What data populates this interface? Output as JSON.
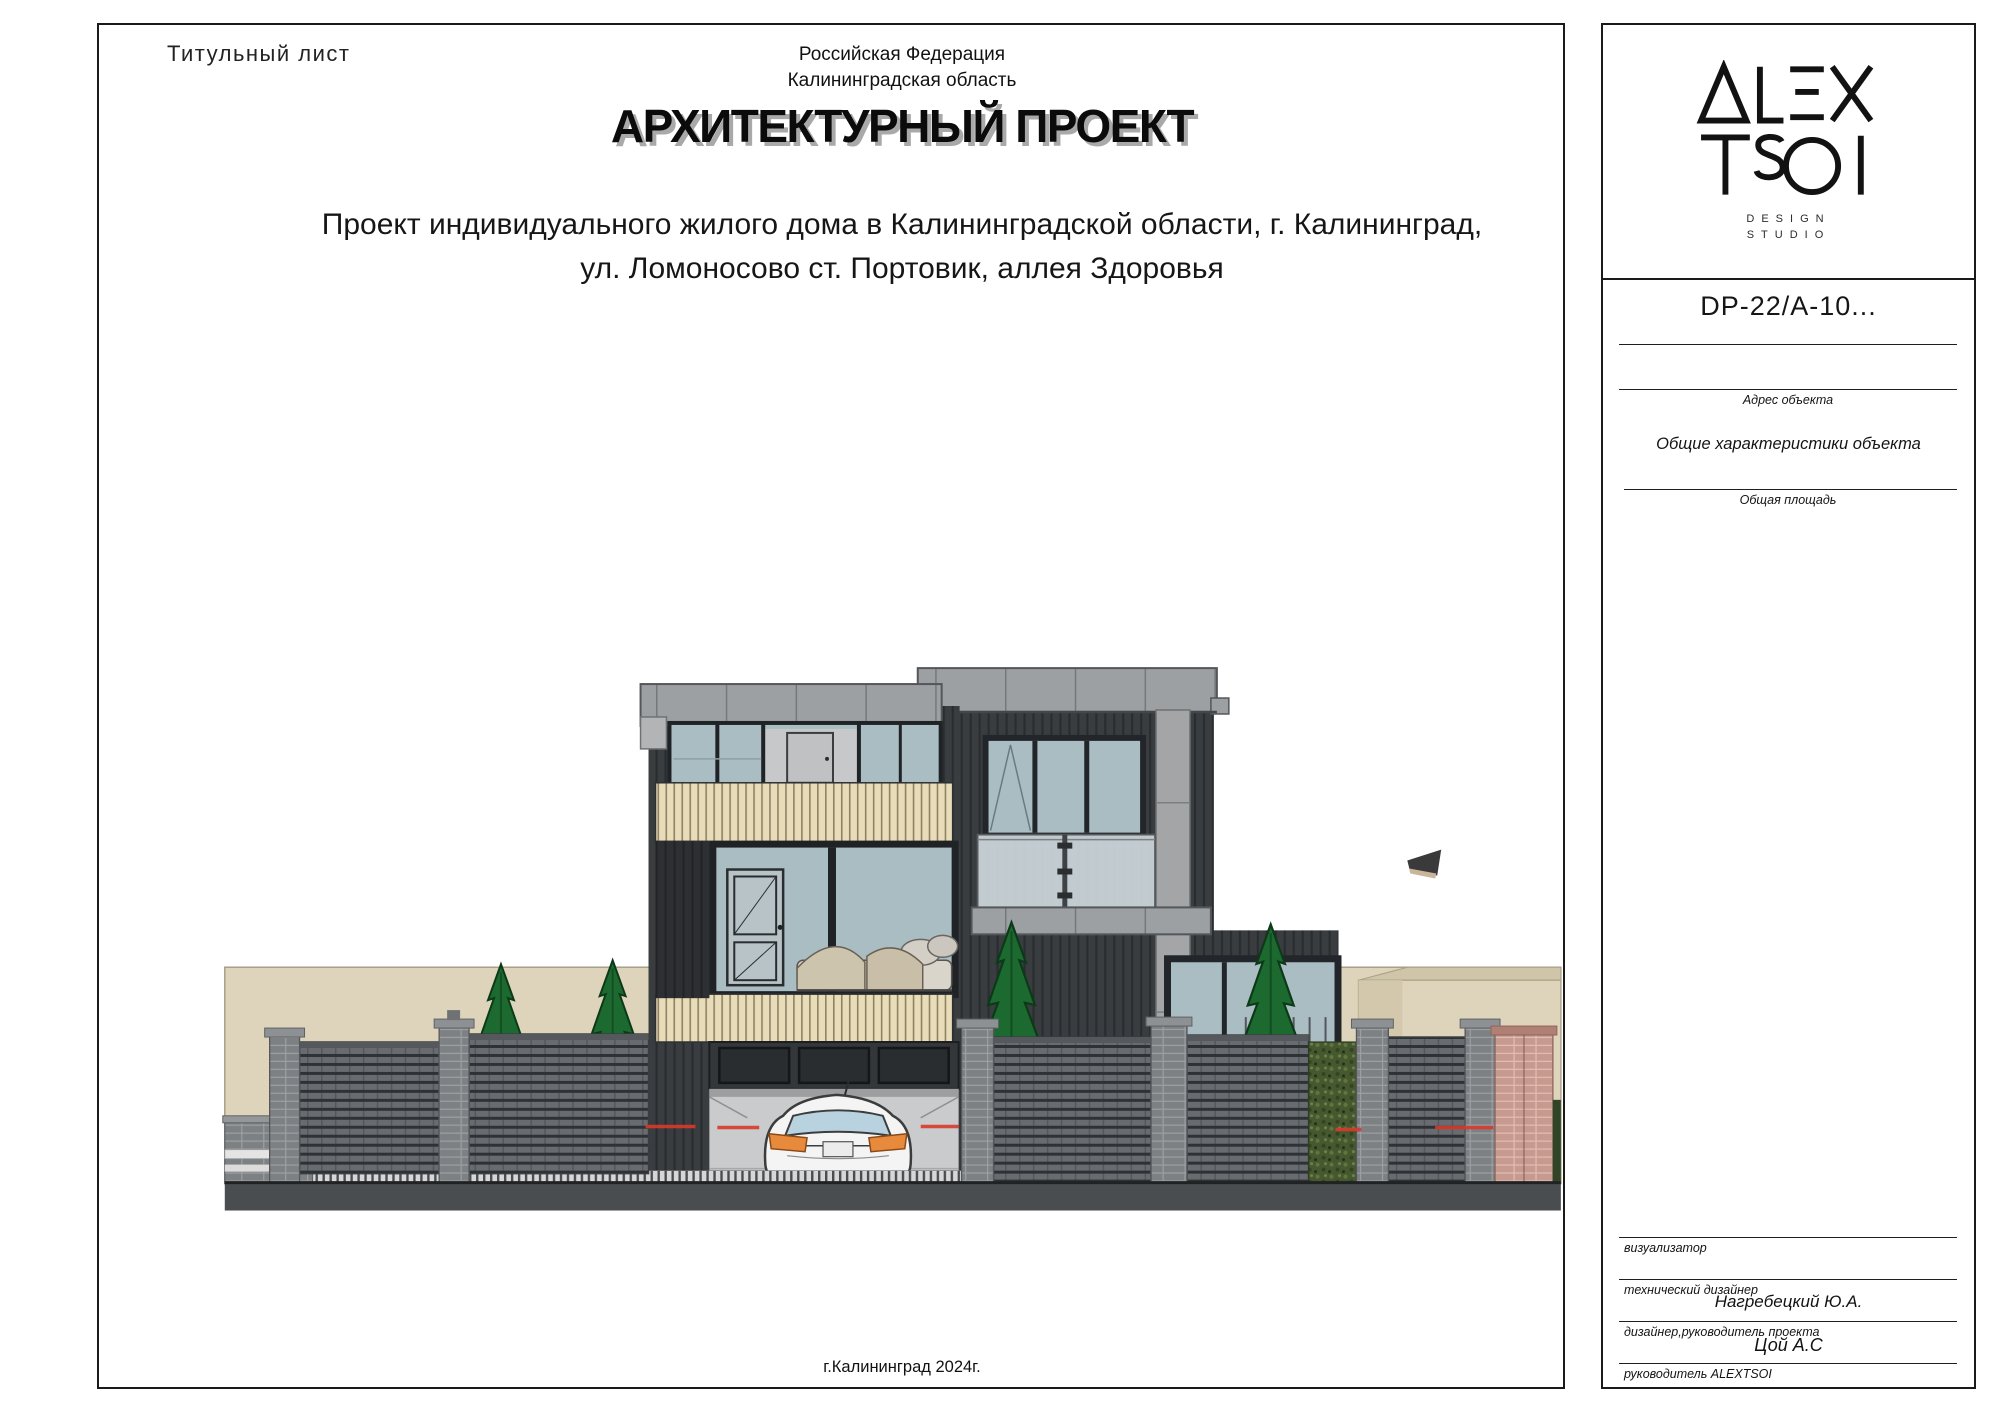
{
  "page": {
    "sheet_label": "Титульный лист",
    "country": "Российская Федерация",
    "region": "Калининградская область",
    "title": "АРХИТЕКТУРНЫЙ ПРОЕКТ",
    "subtitle_line1": "Проект индивидуального жилого дома в Калининградской области, г. Калининград,",
    "subtitle_line2": "ул. Ломоносово ст. Портовик, аллея Здоровья",
    "footer_city": "г.Калининград 2024г."
  },
  "title_block": {
    "logo": {
      "word1": "ALEX",
      "word2": "TSOI",
      "tagline1": "DESIGN",
      "tagline2": "STUDIO"
    },
    "project_code": "DP-22/A-10...",
    "address_label": "Адрес объекта",
    "section_title": "Общие характеристики объекта",
    "area_label": "Общая площадь",
    "signatures": [
      {
        "label": "визуализатор",
        "value": ""
      },
      {
        "label": "технический дизайнер",
        "value": "Нагребецкий Ю.А."
      },
      {
        "label": "дизайнер,руководитель проекта",
        "value": "Цой А.С"
      },
      {
        "label": "руководитель ALEXTSOI",
        "value": ""
      }
    ]
  },
  "illustration": {
    "description": "Front elevation: modern two-storey dark house with garage, white car, slat fence, brick pillars and conifer trees",
    "colors": {
      "facade_dark": "#3a3d40",
      "roof_gray": "#9da0a2",
      "glass": "#a9bdc3",
      "wood_cream": "#e9dcb8",
      "fence_gray": "#686c70",
      "brick_gray": "#7e8184",
      "brick_pink": "#c69a8f",
      "tree_green": "#1d6a31",
      "ground": "#4a4d50",
      "backdrop_beige": "#ded4bb",
      "laser_red": "#d93a2a",
      "car_white": "#f4f4f4",
      "taillight_orange": "#e78a3c"
    }
  }
}
